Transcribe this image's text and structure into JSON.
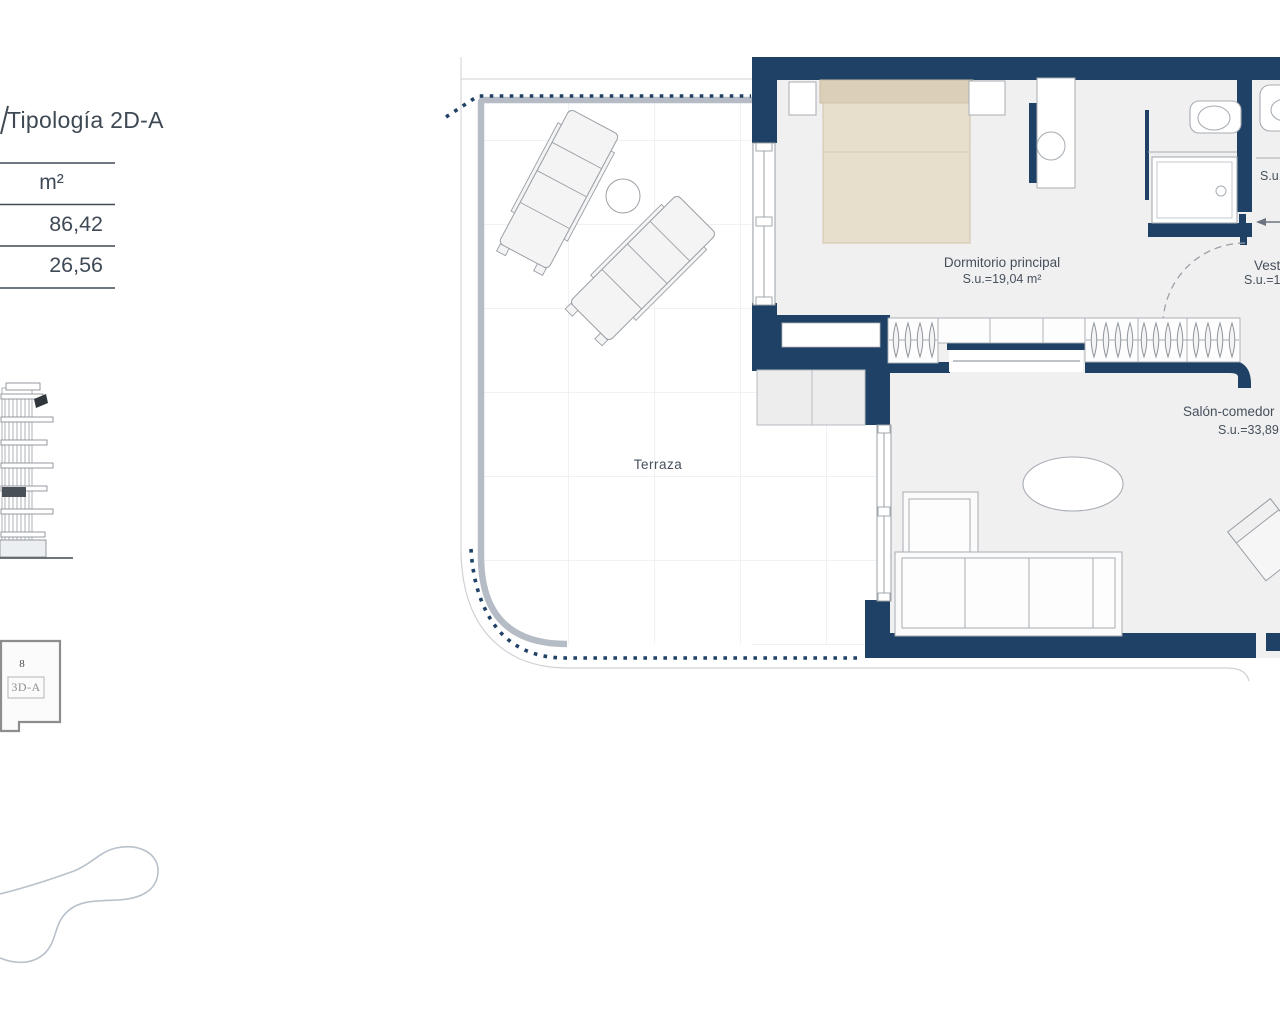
{
  "side_panel": {
    "typology_title": "Tipología 2D-A",
    "area_table": {
      "unit_header": "m²",
      "values": [
        "86,42",
        "26,56"
      ]
    },
    "key_plan": {
      "floor_label": "8",
      "unit_label": "3D-A"
    }
  },
  "floor_plan": {
    "labels": {
      "bedroom_name": "Dormitorio principal",
      "bedroom_area": "S.u.=19,04 m²",
      "living_name": "Salón-comedor",
      "living_area": "S.u.=33,89 m²",
      "terrace_name": "Terraza",
      "bath_area_partial": "S.u.=",
      "vestidor_name": "Vestidor",
      "vestidor_area": "S.u.=1"
    },
    "colors": {
      "wall_navy": "#1f4165",
      "bed_beige": "#e7decb",
      "outline_gray": "#a7adb3",
      "floor_light": "#f0f0f1"
    }
  }
}
